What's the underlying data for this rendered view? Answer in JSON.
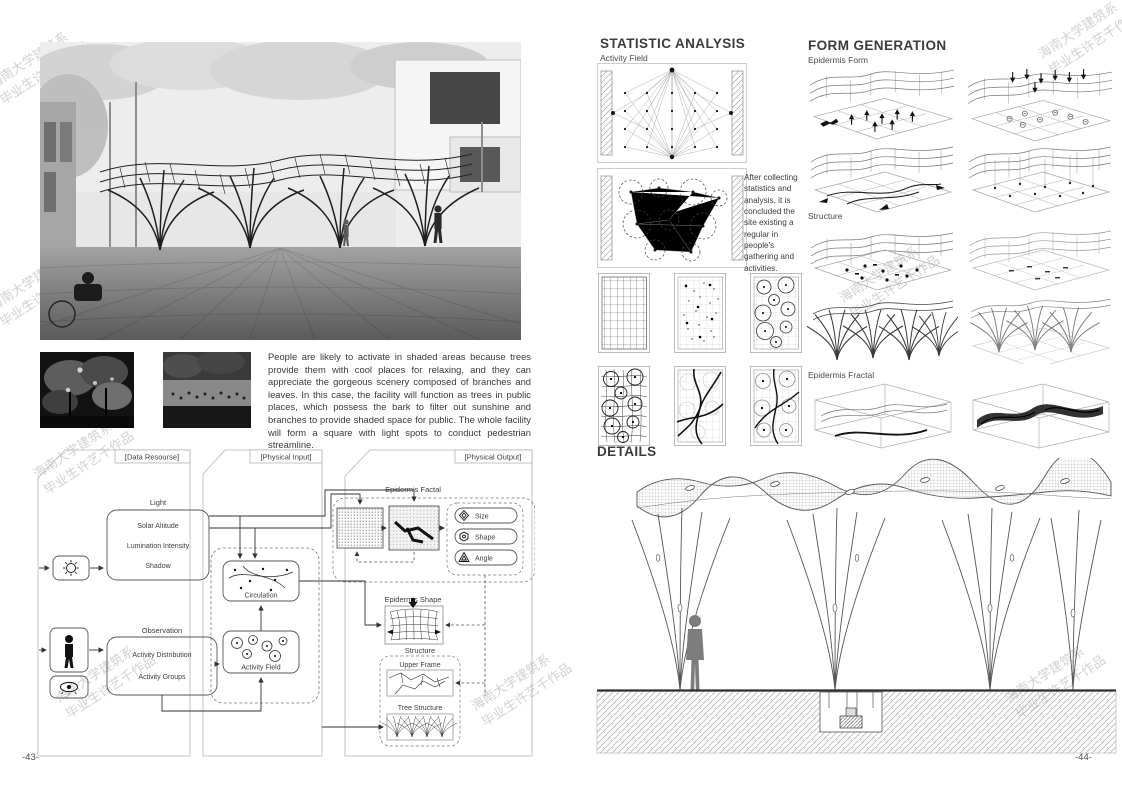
{
  "watermark": {
    "line1": "海南大学建筑系",
    "line2": "毕业生许艺千作品"
  },
  "left_page": {
    "page_number": "-43-",
    "description": "People are likely to activate in shaded areas because trees provide them with cool places for relaxing, and  they can appreciate the gorgeous scenery composed of branches and leaves. In this case, the facility will function as trees in public places, which possess the bark to filter out sunshine and branches to provide shaded space for public. The whole facility will form a square with light spots to conduct pedestrian streamline.",
    "flowchart": {
      "headers": {
        "data_resource": "[Data Resourse]",
        "physical_input": "[Physical Input]",
        "physical_output": "[Physical Output]"
      },
      "light": {
        "label": "Light",
        "items": [
          "Solar Altitude",
          "Lumination Intensity",
          "Shadow"
        ]
      },
      "observation": {
        "label": "Observation",
        "items": [
          "Activity Distribution",
          "Activity Groups"
        ]
      },
      "circulation_label": "Circulation",
      "activity_field_label": "Activity Field",
      "epidermis_factal_label": "Epidermis Factal",
      "attribute_pills": [
        "Size",
        "Shape",
        "Angle"
      ],
      "epidermis_shape_label": "Epidermis Shape",
      "structure_label": "Structure",
      "upper_frame_label": "Upper Frame",
      "tree_structure_label": "Tree Structure",
      "icons": [
        "sun-icon",
        "person-icon",
        "eye-icon",
        "diamond-icon",
        "hexagon-icon",
        "triangle-icon"
      ]
    }
  },
  "right_page": {
    "page_number": "-44-",
    "statistic_analysis": {
      "title": "STATISTIC ANALYSIS",
      "activity_field_label": "Activity Field",
      "note": "After collecting statistics and analysis, it is concluded the site existing a regular in people's gathering and activities."
    },
    "form_generation": {
      "title": "FORM GENERATION",
      "epidermis_form_label": "Epidermis Form",
      "structure_label": "Structure",
      "epidermis_fractal_label": "Epidermis Fractal"
    },
    "details_title": "DETAILS"
  }
}
